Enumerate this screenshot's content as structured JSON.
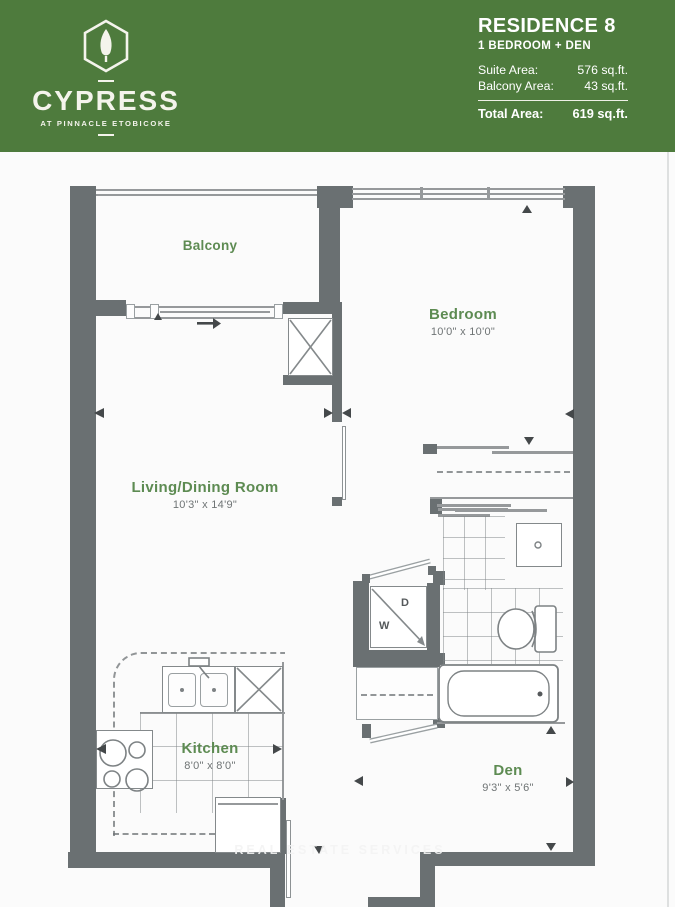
{
  "header": {
    "background_color": "#4e7b3d",
    "brand": {
      "logo_icon": "cypress-hexagon-tree-logo",
      "name": "CYPRESS",
      "tagline": "AT PINNACLE ETOBICOKE"
    },
    "residence": {
      "title": "RESIDENCE 8",
      "subtitle": "1 BEDROOM + DEN",
      "areas": [
        {
          "label": "Suite Area:",
          "value": "576 sq.ft."
        },
        {
          "label": "Balcony Area:",
          "value": "43 sq.ft."
        }
      ],
      "total": {
        "label": "Total Area:",
        "value": "619 sq.ft."
      }
    }
  },
  "floorplan": {
    "colors": {
      "wall": "#6a7072",
      "thin_line": "#96999b",
      "room_label": "#5d8b52",
      "dimension_text": "#6f7475",
      "background": "#fbfbfb"
    },
    "rooms": {
      "balcony": {
        "name": "Balcony"
      },
      "bedroom": {
        "name": "Bedroom",
        "dimensions": "10'0\" x 10'0\""
      },
      "living": {
        "name": "Living/Dining Room",
        "dimensions": "10'3\" x 14'9\""
      },
      "kitchen": {
        "name": "Kitchen",
        "dimensions": "8'0\" x 8'0\""
      },
      "den": {
        "name": "Den",
        "dimensions": "9'3\" x 5'6\""
      }
    },
    "appliances": {
      "washer_label": "W",
      "dryer_label": "D"
    },
    "watermark": "REAL ESTATE SERVICES"
  }
}
